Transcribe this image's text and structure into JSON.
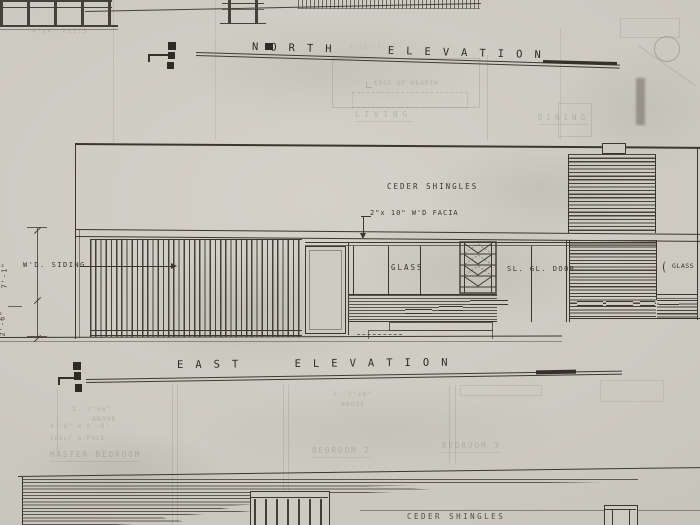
{
  "north": {
    "title": "NORTH ELEVATION",
    "shingles_label": "CEDER SHINGLES",
    "facia_label": "2\"x 10\" W'D FACIA",
    "siding_label": "W'D. SIDING",
    "glass_label": "GLASS",
    "door_label": "SL. GL. DOOR",
    "glass_right_label": "GLASS",
    "dim_upper": "7'-1\"",
    "dim_lower": "2'-6\""
  },
  "east": {
    "title": "EAST ELEVATION",
    "shingles_label": "CEDER SHINGLES"
  },
  "ghost": {
    "posts": "4\"x4\" POSTS",
    "fireplace": "FIREPLACE",
    "hearth": "EDGE OF HEARTH",
    "living": "LIVING",
    "dining": "DINING",
    "note1a": "2- 2\"x6\"",
    "note1b": "ABOVE",
    "note2a": "2- 2\"x6\"",
    "note2b": "ABOVE",
    "shelf1": "4'-6\" x 0'-6\"",
    "shelf2": "SHELF & POLE",
    "master_bedroom": "MASTER BEDROOM",
    "bedroom2": "BEDROOM 2",
    "bedroom3": "BEDROOM 3"
  },
  "colors": {
    "paper": "#cbc8c0",
    "ink": "#3b372f",
    "ghost": "#7e7a6c"
  }
}
